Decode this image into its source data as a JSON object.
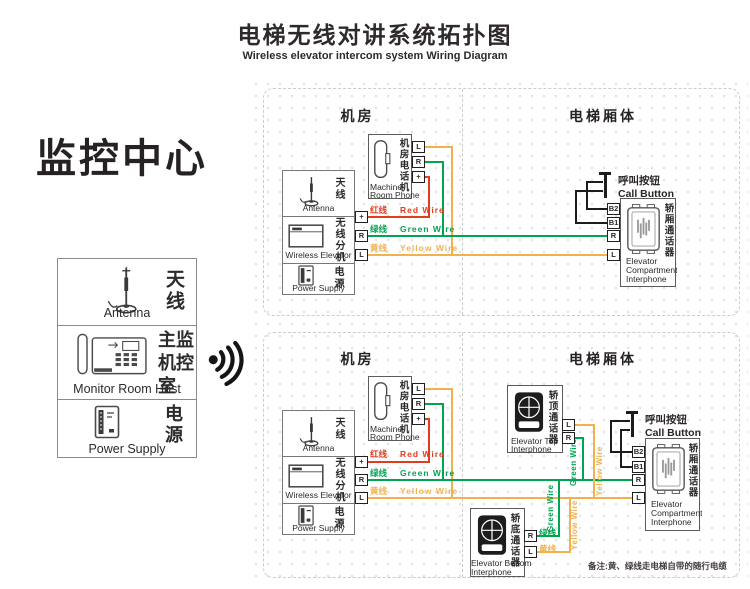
{
  "colors": {
    "red": "#e23b1e",
    "green": "#00a551",
    "yellow": "#f2b14f",
    "black_wire": "#1c1c1c"
  },
  "header": {
    "title": "电梯无线对讲系统拓扑图",
    "subtitle": "Wireless elevator intercom system Wiring Diagram"
  },
  "monitor_center": {
    "title": "监控中心",
    "antenna_cn": "天线",
    "antenna_en": "Antenna",
    "host_cn": "主监机控室",
    "host_en": "Monitor Room Host",
    "power_cn": "电源",
    "power_en": "Power Supply"
  },
  "section_headers": {
    "machine_room": "机房",
    "elevator_car": "电梯厢体"
  },
  "devices": {
    "machine_room_phone": {
      "cn": "机房电话机",
      "en1": "Machine",
      "en2": "Room Phone"
    },
    "antenna": {
      "cn": "天线",
      "en": "Antenna"
    },
    "wireless_unit": {
      "cn": "无线分机",
      "en": "Wireless Elevator"
    },
    "power": {
      "cn": "电源",
      "en": "Power Supply"
    },
    "compartment_interphone": {
      "cn": "轿厢通话器",
      "en1": "Elevator",
      "en2": "Compartment",
      "en3": "Interphone"
    },
    "top_interphone": {
      "cn": "轿顶通话器",
      "en1": "Elevator Top",
      "en2": "Interphone"
    },
    "bottom_interphone": {
      "cn": "轿底通话器",
      "en1": "Elevator Bottom",
      "en2": "Interphone"
    },
    "call_button": {
      "cn": "呼叫按钮",
      "en": "Call Button"
    }
  },
  "wires": {
    "red_cn": "红线",
    "red_en": "Red Wire",
    "green_cn": "绿线",
    "green_en": "Green Wire",
    "yellow_cn": "黄线",
    "yellow_en": "Yellow Wire"
  },
  "terminals": {
    "L": "L",
    "R": "R",
    "plus": "+",
    "B1": "B1",
    "B2": "B2"
  },
  "note": "备注:黄、绿线走电梯自带的随行电缆"
}
